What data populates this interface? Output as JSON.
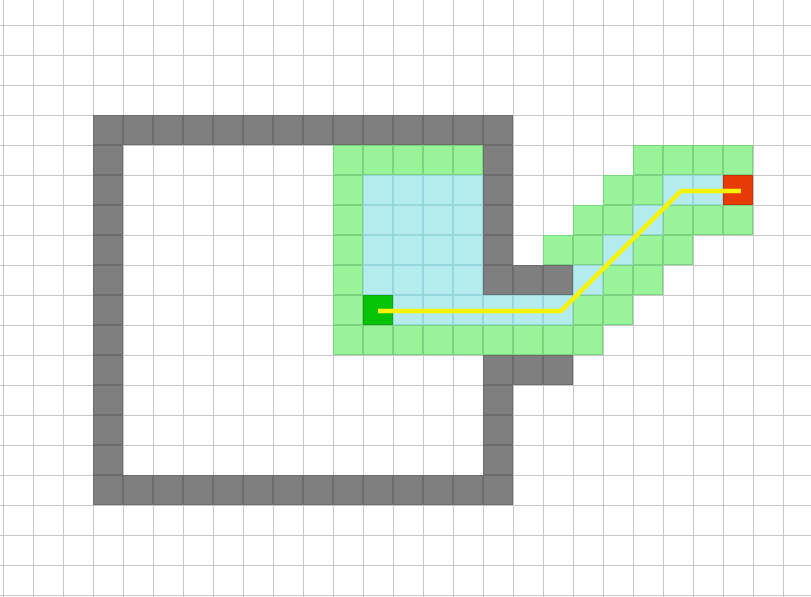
{
  "canvas": {
    "width": 811,
    "height": 597,
    "background": "#ffffff"
  },
  "grid": {
    "cell_size": 30,
    "origin_x": 3,
    "origin_y": 25,
    "visible_columns": 27,
    "visible_rows": 20,
    "line_color": "#c7c7c7"
  },
  "palette": {
    "wall_fill": "#7f7f7f",
    "wall_border": "#6c6c6c",
    "frontier_fill": "#99f399",
    "frontier_border": "#7cd37f",
    "visited_fill": "#b4ecee",
    "visited_border": "#96d7db",
    "start_fill": "#06c306",
    "start_border": "#0aa50a",
    "goal_fill": "#e83a07",
    "goal_border": "#c53208",
    "path_color": "#f8f303"
  },
  "cells": {
    "walls": [
      [
        3,
        3
      ],
      [
        4,
        3
      ],
      [
        5,
        3
      ],
      [
        6,
        3
      ],
      [
        7,
        3
      ],
      [
        8,
        3
      ],
      [
        9,
        3
      ],
      [
        10,
        3
      ],
      [
        11,
        3
      ],
      [
        12,
        3
      ],
      [
        13,
        3
      ],
      [
        14,
        3
      ],
      [
        15,
        3
      ],
      [
        16,
        3
      ],
      [
        3,
        4
      ],
      [
        3,
        5
      ],
      [
        3,
        6
      ],
      [
        3,
        7
      ],
      [
        3,
        8
      ],
      [
        3,
        9
      ],
      [
        3,
        10
      ],
      [
        3,
        11
      ],
      [
        3,
        12
      ],
      [
        3,
        13
      ],
      [
        3,
        14
      ],
      [
        3,
        15
      ],
      [
        4,
        15
      ],
      [
        5,
        15
      ],
      [
        6,
        15
      ],
      [
        7,
        15
      ],
      [
        8,
        15
      ],
      [
        9,
        15
      ],
      [
        10,
        15
      ],
      [
        11,
        15
      ],
      [
        12,
        15
      ],
      [
        13,
        15
      ],
      [
        14,
        15
      ],
      [
        15,
        15
      ],
      [
        16,
        15
      ],
      [
        16,
        4
      ],
      [
        16,
        5
      ],
      [
        16,
        6
      ],
      [
        16,
        7
      ],
      [
        16,
        8
      ],
      [
        17,
        8
      ],
      [
        18,
        8
      ],
      [
        16,
        11
      ],
      [
        17,
        11
      ],
      [
        18,
        11
      ],
      [
        16,
        12
      ],
      [
        16,
        13
      ],
      [
        16,
        14
      ]
    ],
    "frontier": [
      [
        11,
        4
      ],
      [
        12,
        4
      ],
      [
        13,
        4
      ],
      [
        14,
        4
      ],
      [
        15,
        4
      ],
      [
        21,
        4
      ],
      [
        22,
        4
      ],
      [
        23,
        4
      ],
      [
        24,
        4
      ],
      [
        11,
        5
      ],
      [
        20,
        5
      ],
      [
        21,
        5
      ],
      [
        11,
        6
      ],
      [
        19,
        6
      ],
      [
        20,
        6
      ],
      [
        22,
        6
      ],
      [
        23,
        6
      ],
      [
        24,
        6
      ],
      [
        11,
        7
      ],
      [
        18,
        7
      ],
      [
        19,
        7
      ],
      [
        21,
        7
      ],
      [
        22,
        7
      ],
      [
        11,
        8
      ],
      [
        20,
        8
      ],
      [
        21,
        8
      ],
      [
        11,
        9
      ],
      [
        19,
        9
      ],
      [
        20,
        9
      ],
      [
        11,
        10
      ],
      [
        12,
        10
      ],
      [
        13,
        10
      ],
      [
        14,
        10
      ],
      [
        15,
        10
      ],
      [
        16,
        10
      ],
      [
        17,
        10
      ],
      [
        18,
        10
      ],
      [
        19,
        10
      ]
    ],
    "visited": [
      [
        12,
        5
      ],
      [
        13,
        5
      ],
      [
        14,
        5
      ],
      [
        15,
        5
      ],
      [
        22,
        5
      ],
      [
        23,
        5
      ],
      [
        12,
        6
      ],
      [
        13,
        6
      ],
      [
        14,
        6
      ],
      [
        15,
        6
      ],
      [
        21,
        6
      ],
      [
        12,
        7
      ],
      [
        13,
        7
      ],
      [
        14,
        7
      ],
      [
        15,
        7
      ],
      [
        20,
        7
      ],
      [
        12,
        8
      ],
      [
        13,
        8
      ],
      [
        14,
        8
      ],
      [
        15,
        8
      ],
      [
        19,
        8
      ],
      [
        13,
        9
      ],
      [
        14,
        9
      ],
      [
        15,
        9
      ],
      [
        16,
        9
      ],
      [
        17,
        9
      ],
      [
        18,
        9
      ]
    ],
    "start": [
      12,
      9
    ],
    "goal": [
      24,
      5
    ]
  },
  "path": {
    "points": [
      [
        378,
        311
      ],
      [
        561,
        311
      ],
      [
        681,
        191
      ],
      [
        741,
        191
      ]
    ],
    "stroke_width": 4.5
  }
}
